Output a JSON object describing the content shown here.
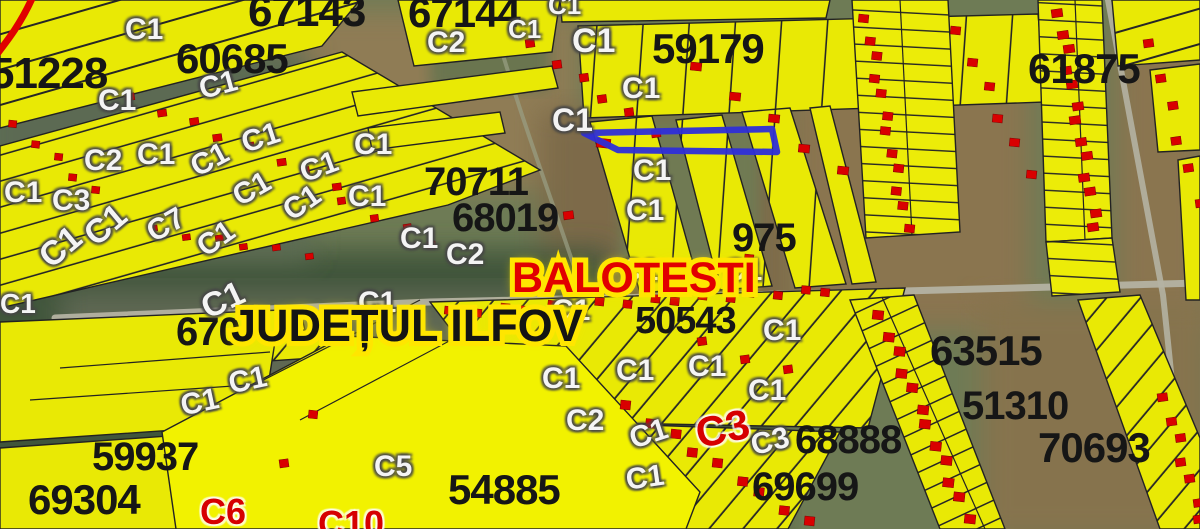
{
  "map": {
    "region": "cadastral satellite overlay",
    "city_label": {
      "text": "BALOTESTI",
      "x": 512,
      "y": 212,
      "size": 43,
      "fill": "#e10000"
    },
    "county_label": {
      "text": "JUDEȚUL ILFOV",
      "x": 231,
      "y": 303,
      "size": 45,
      "fill": "#141414"
    },
    "parcel_numbers": [
      {
        "text": "51228",
        "x": -10,
        "y": 52,
        "size": 44
      },
      {
        "text": "60685",
        "x": 176,
        "y": 38,
        "size": 42
      },
      {
        "text": "67143",
        "x": 248,
        "y": -10,
        "size": 44
      },
      {
        "text": "67144",
        "x": 408,
        "y": -8,
        "size": 42
      },
      {
        "text": "59179",
        "x": 652,
        "y": 28,
        "size": 42
      },
      {
        "text": "61875",
        "x": 1028,
        "y": 48,
        "size": 42
      },
      {
        "text": "70711",
        "x": 424,
        "y": 162,
        "size": 40
      },
      {
        "text": "68019",
        "x": 452,
        "y": 198,
        "size": 40
      },
      {
        "text": "975",
        "x": 732,
        "y": 218,
        "size": 40
      },
      {
        "text": "50543",
        "x": 635,
        "y": 302,
        "size": 38
      },
      {
        "text": "670",
        "x": 176,
        "y": 312,
        "size": 40
      },
      {
        "text": "63515",
        "x": 930,
        "y": 330,
        "size": 42
      },
      {
        "text": "68888",
        "x": 795,
        "y": 420,
        "size": 40
      },
      {
        "text": "51310",
        "x": 962,
        "y": 386,
        "size": 40
      },
      {
        "text": "70693",
        "x": 1038,
        "y": 427,
        "size": 42
      },
      {
        "text": "69699",
        "x": 752,
        "y": 467,
        "size": 40
      },
      {
        "text": "54885",
        "x": 448,
        "y": 469,
        "size": 42
      },
      {
        "text": "59937",
        "x": 92,
        "y": 437,
        "size": 40
      },
      {
        "text": "69304",
        "x": 28,
        "y": 479,
        "size": 42
      }
    ],
    "construction_labels": [
      {
        "text": "C1",
        "x": 125,
        "y": 15
      },
      {
        "text": "C1",
        "x": 98,
        "y": 86
      },
      {
        "text": "C1",
        "x": 196,
        "y": 76,
        "rot": -15
      },
      {
        "text": "C2",
        "x": 427,
        "y": 28
      },
      {
        "text": "C1",
        "x": 508,
        "y": 16,
        "size": 26
      },
      {
        "text": "C1",
        "x": 548,
        "y": -8,
        "size": 26
      },
      {
        "text": "C1",
        "x": 572,
        "y": 24,
        "size": 34
      },
      {
        "text": "C1",
        "x": 622,
        "y": 74
      },
      {
        "text": "C1",
        "x": 552,
        "y": 104,
        "size": 32
      },
      {
        "text": "C2",
        "x": 84,
        "y": 146
      },
      {
        "text": "C1",
        "x": 137,
        "y": 140
      },
      {
        "text": "C1",
        "x": 238,
        "y": 130,
        "rot": -18
      },
      {
        "text": "C1",
        "x": 186,
        "y": 156,
        "rot": -28
      },
      {
        "text": "C1",
        "x": 296,
        "y": 160,
        "rot": -20
      },
      {
        "text": "C1",
        "x": 354,
        "y": 130
      },
      {
        "text": "C1",
        "x": 4,
        "y": 178
      },
      {
        "text": "C3",
        "x": 52,
        "y": 186
      },
      {
        "text": "C1",
        "x": 228,
        "y": 186,
        "rot": -30
      },
      {
        "text": "C1",
        "x": 278,
        "y": 202,
        "rot": -35
      },
      {
        "text": "C1",
        "x": 348,
        "y": 182
      },
      {
        "text": "C1",
        "x": 78,
        "y": 226,
        "rot": -40,
        "size": 34
      },
      {
        "text": "C1",
        "x": 33,
        "y": 248,
        "rot": -40,
        "size": 34
      },
      {
        "text": "C7",
        "x": 142,
        "y": 222,
        "rot": -30
      },
      {
        "text": "C1",
        "x": 192,
        "y": 238,
        "rot": -35
      },
      {
        "text": "C1",
        "x": 0,
        "y": 290,
        "size": 28
      },
      {
        "text": "C1",
        "x": 196,
        "y": 294,
        "rot": -25,
        "size": 34
      },
      {
        "text": "C1",
        "x": 358,
        "y": 288
      },
      {
        "text": "C1",
        "x": 400,
        "y": 224
      },
      {
        "text": "C2",
        "x": 446,
        "y": 240
      },
      {
        "text": "C1",
        "x": 633,
        "y": 156
      },
      {
        "text": "C1",
        "x": 626,
        "y": 196
      },
      {
        "text": "C1",
        "x": 620,
        "y": 256
      },
      {
        "text": "C1",
        "x": 724,
        "y": 256
      },
      {
        "text": "C1",
        "x": 552,
        "y": 296
      },
      {
        "text": "C1",
        "x": 763,
        "y": 316
      },
      {
        "text": "C1",
        "x": 542,
        "y": 364
      },
      {
        "text": "C1",
        "x": 616,
        "y": 356
      },
      {
        "text": "C1",
        "x": 688,
        "y": 352
      },
      {
        "text": "C1",
        "x": 748,
        "y": 376
      },
      {
        "text": "C2",
        "x": 566,
        "y": 406
      },
      {
        "text": "C1",
        "x": 626,
        "y": 426,
        "rot": -18
      },
      {
        "text": "C3",
        "x": 692,
        "y": 414,
        "rot": -12,
        "red": true,
        "size": 42
      },
      {
        "text": "C3",
        "x": 748,
        "y": 432,
        "rot": -14
      },
      {
        "text": "C1",
        "x": 624,
        "y": 466,
        "rot": -8
      },
      {
        "text": "C5",
        "x": 374,
        "y": 452
      },
      {
        "text": "C6",
        "x": 200,
        "y": 494,
        "red": true,
        "size": 36
      },
      {
        "text": "C10",
        "x": 318,
        "y": 506,
        "red": true,
        "size": 36
      },
      {
        "text": "C1",
        "x": 178,
        "y": 392,
        "rot": -12
      },
      {
        "text": "C1",
        "x": 226,
        "y": 370,
        "rot": -12
      }
    ],
    "colors": {
      "parcel_yellow": "#e9e905",
      "bright_parcel_yellow": "#f2f200",
      "building_red": "#d90000",
      "highlight_blue": "#2e2ed8",
      "city_label_red": "#e10000",
      "label_halo_yellow": "#ffe600",
      "construction_label_white": "#f4f4f4",
      "road_gray": "#b4b2a2"
    }
  }
}
